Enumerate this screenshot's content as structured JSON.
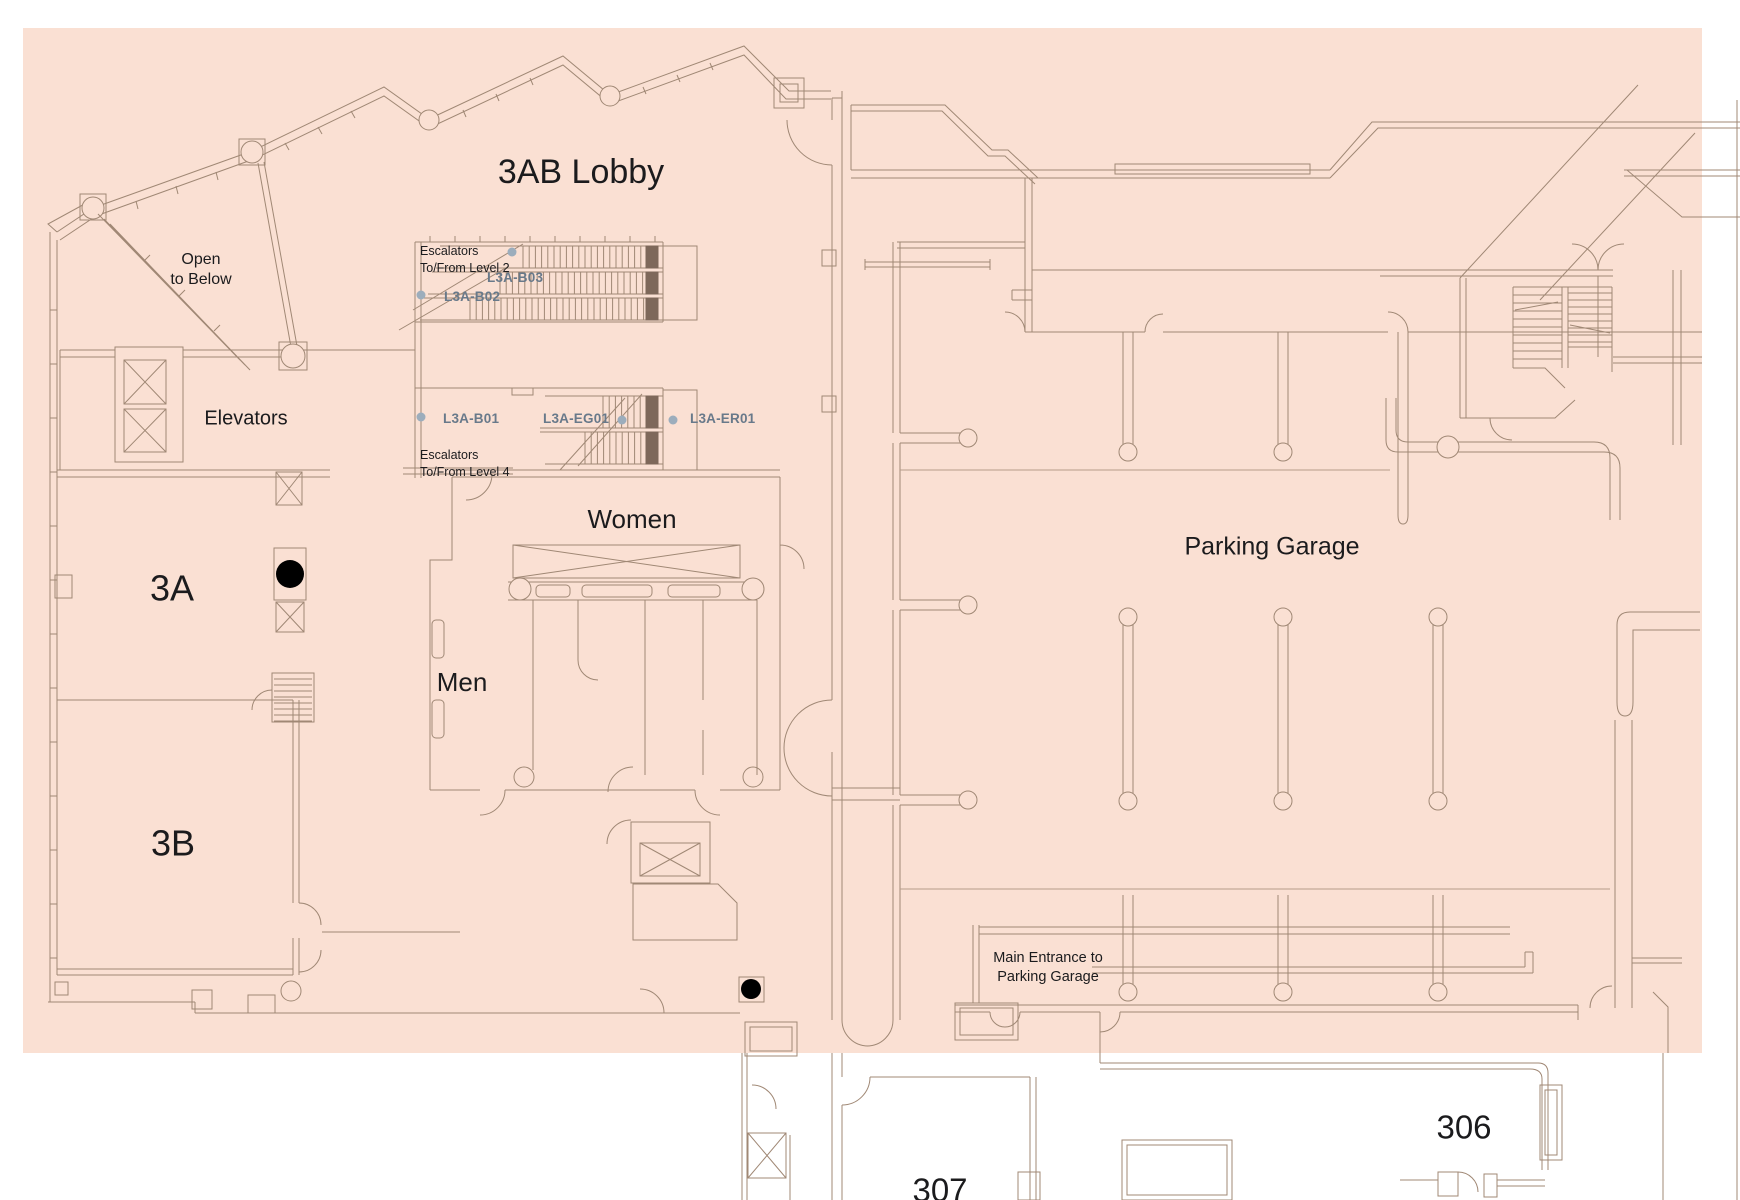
{
  "map": {
    "title": "3AB Lobby",
    "areas": {
      "lobby": "3AB Lobby",
      "open_to_below": {
        "line1": "Open",
        "line2": "to Below"
      },
      "elevators": "Elevators",
      "escalators_level2": {
        "line1": "Escalators",
        "line2": "To/From Level 2"
      },
      "escalators_level4": {
        "line1": "Escalators",
        "line2": "To/From Level 4"
      },
      "women": "Women",
      "men": "Men",
      "room_3a": "3A",
      "room_3b": "3B",
      "parking_garage": "Parking Garage",
      "main_entrance": {
        "line1": "Main Entrance to",
        "line2": "Parking Garage"
      },
      "room_306": "306",
      "room_307": "307"
    },
    "escalator_codes": [
      "L3A-B03",
      "L3A-B02",
      "L3A-B01",
      "L3A-EG01",
      "L3A-ER01"
    ],
    "colors": {
      "highlight": "#fae0d3",
      "wall_line": "#a08875",
      "dark_line": "#7e685a",
      "label_text": "#1b1b1d",
      "code_text": "#68798a",
      "marker_dot": "#9cadbc",
      "canvas": "#ffffff"
    }
  }
}
